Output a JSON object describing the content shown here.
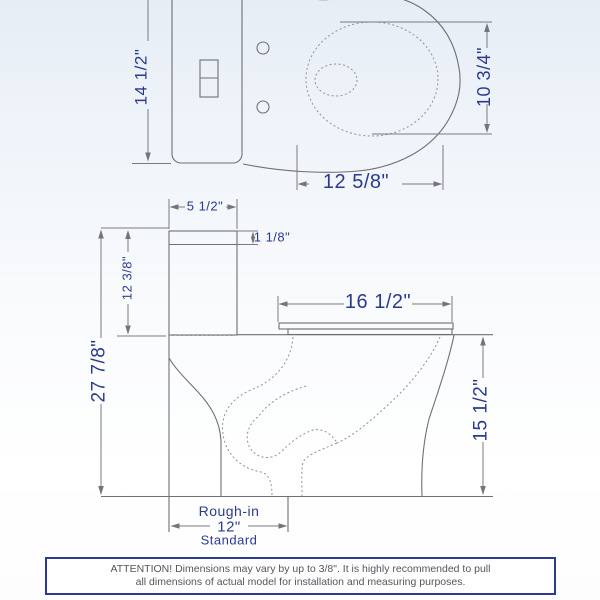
{
  "top_view": {
    "overall_width": "14 1/2\"",
    "bowl_inner_width": "10 3/4\"",
    "bowl_inner_length": "12 5/8\""
  },
  "side_view": {
    "tank_depth": "5 1/2\"",
    "lid_thickness": "1 1/8\"",
    "tank_height": "12 3/8\"",
    "overall_height": "27 7/8\"",
    "rim_length": "16 1/2\"",
    "rim_height": "15 1/2\"",
    "rough_in": {
      "title": "Rough-in",
      "value": "12\"",
      "subtitle": "Standard"
    }
  },
  "attention": {
    "line1": "ATTENTION! Dimensions may vary by up to 3/8\". It is highly recommended to pull",
    "line2": "all dimensions of actual model for installation and measuring purposes."
  },
  "colors": {
    "dimension_text": "#2b3a8f",
    "drawing_line": "#6f6f77",
    "attention_border": "#2b3990",
    "attention_text": "#54555e",
    "background_top": "#e7edf5"
  }
}
